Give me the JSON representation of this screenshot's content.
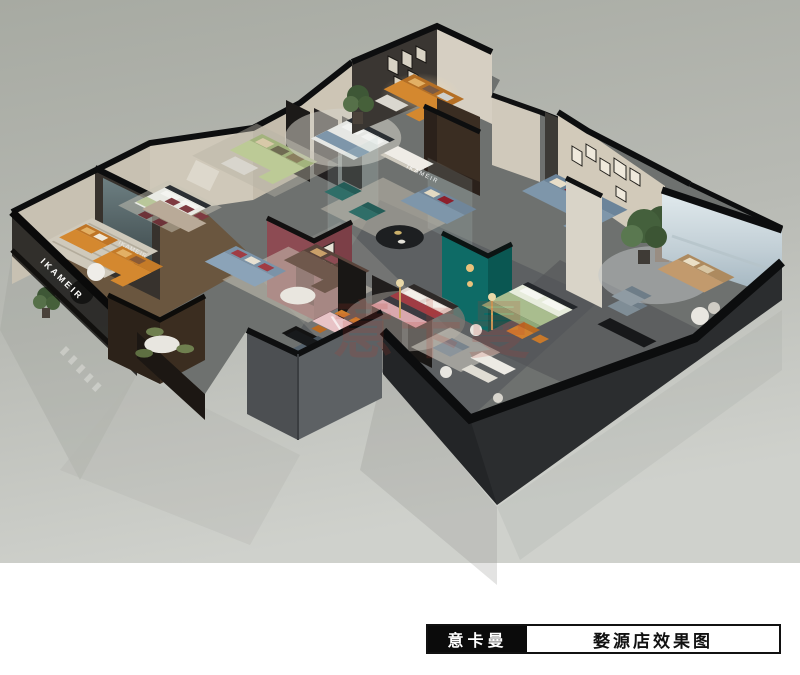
{
  "scene": {
    "description": "3D isometric cutaway rendering of a furniture showroom floor plan on a dark plinth with glossy studio ground"
  },
  "title_block": {
    "brand": "意卡曼",
    "caption": "婺源店效果图"
  },
  "signs": {
    "storefront_sign": "IKAMEIR",
    "back_wall_sign": "IKAMEIR",
    "reception_sign": "IKAMEIR"
  },
  "watermark": {
    "text": "意卡曼",
    "color": "#c0392b"
  },
  "palette": {
    "background_top": "#a9aca4",
    "background_bottom": "#cdcfca",
    "white_band": "#ffffff",
    "plinth": "#232527",
    "wall_black": "#0d0e0f",
    "wall_beige": "#cec7b8",
    "wall_dark_texture": "#37322d",
    "teal_wall": "#0e6b66",
    "maroon_wall": "#8d4b53",
    "wood_floor": "#6a563f",
    "concrete": "#6e716f",
    "sofa_orange": "#d4882f",
    "sofa_sage": "#bcca96",
    "sofa_blue": "#8ba3b8",
    "sofa_steelblue": "#7e96aa",
    "sofa_brown": "#6f584c",
    "sofa_tan": "#c29a6d",
    "bed_green": "#a9bd8e",
    "bed_pink": "#d9a8ad",
    "chair_orange": "#d07f2e",
    "accent_red": "#a03c44",
    "sea_view_top": "#e2ebee",
    "sea_view_bottom": "#9fb2bd",
    "rug_light": "#cfc9bb",
    "plant_green": "#46603a"
  }
}
